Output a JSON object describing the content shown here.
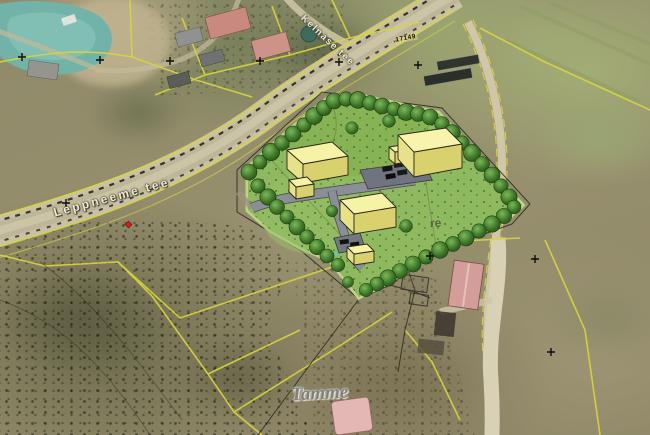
{
  "map": {
    "labels": {
      "main_road": "Leppneeme tee",
      "side_road": "Kelnase tee",
      "road_number": "17149",
      "partial_place": "re",
      "place_name": "Tamme"
    },
    "colors": {
      "water": "#72b3a9",
      "site_lawn": "#8fb95e",
      "site_tree": "#3c7527",
      "proposed_building": "#f6f2a6",
      "internal_road": "#8a8e97",
      "parking": "#70747e",
      "cadastral_line": "#d8d43c",
      "road_surface": "#c6bfa2",
      "existing_red_roof": "#c9897e",
      "marker_red": "#cc2211"
    }
  }
}
